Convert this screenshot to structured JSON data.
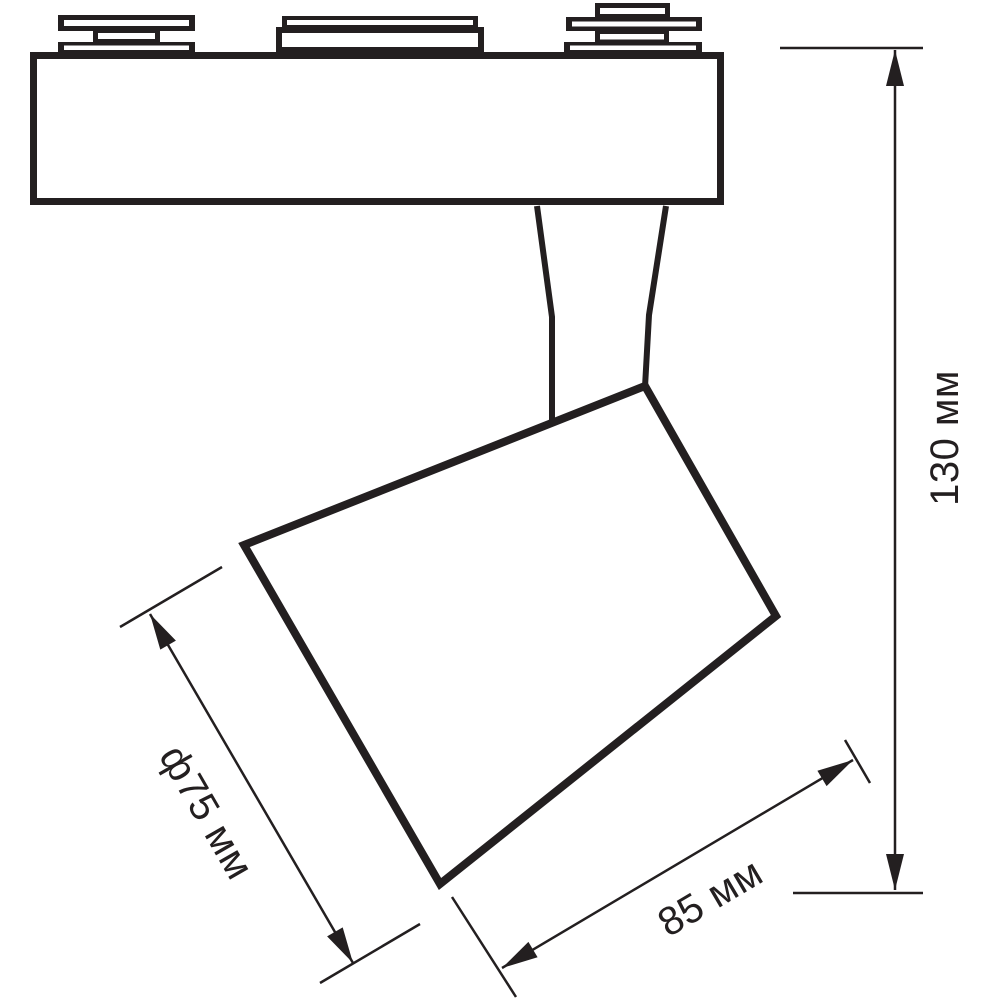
{
  "page": {
    "background": "#ffffff",
    "line_color": "#231f20"
  },
  "drawing": {
    "title": "track-light-fixture-dimension-drawing",
    "dimensions": [
      {
        "name": "lamp-head-diameter",
        "label": "ф75 мм",
        "value": 75,
        "unit": "мм"
      },
      {
        "name": "lamp-head-length",
        "label": "85 мм",
        "value": 85,
        "unit": "мм"
      },
      {
        "name": "overall-height",
        "label": "130 мм",
        "value": 130,
        "unit": "мм"
      }
    ]
  }
}
